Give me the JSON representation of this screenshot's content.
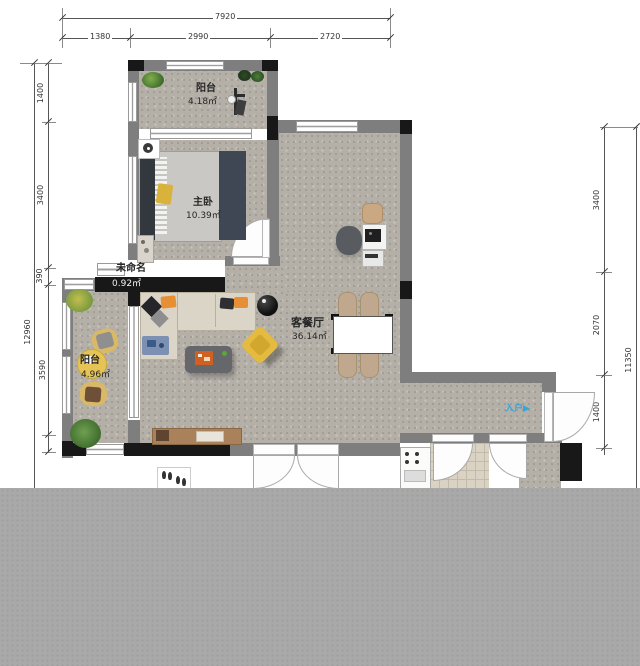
{
  "plan": {
    "dimensions": {
      "top": {
        "total": "7920",
        "seg1": "1380",
        "seg2": "2990",
        "seg3": "2720"
      },
      "left": {
        "total": "12960",
        "seg1": "1400",
        "seg2": "3400",
        "seg3": "390",
        "seg4": "3590"
      },
      "right": {
        "total": "11350",
        "seg1": "3400",
        "seg2": "2070",
        "seg3": "1400"
      }
    },
    "rooms": {
      "balcony_top": {
        "name": "阳台",
        "area": "4.18㎡"
      },
      "master_bedroom": {
        "name": "主卧",
        "area": "10.39㎡"
      },
      "unnamed": {
        "name": "未命名",
        "area": "0.92㎡"
      },
      "living_dining": {
        "name": "客餐厅",
        "area": "36.14㎡"
      },
      "balcony_left": {
        "name": "阳台",
        "area": "4.96㎡"
      }
    },
    "entry": {
      "label": "入户",
      "arrow": "▶",
      "color": "#2fa8e1"
    }
  }
}
